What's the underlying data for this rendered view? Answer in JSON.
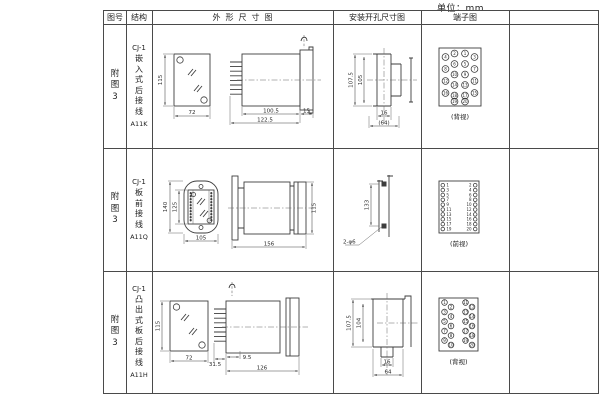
{
  "unit_label": "单位：mm",
  "header": {
    "figure": "图号",
    "structure": "结构",
    "outline": "外形尺寸图",
    "mounting": "安装开孔尺寸图",
    "terminal": "端子图"
  },
  "rows": [
    {
      "figure": "附图3",
      "series": "CJ-1",
      "structure": "嵌入式后接线",
      "model": "A11K",
      "outline": {
        "front_h": "115",
        "front_w": "72",
        "side_a": "100.5",
        "side_b": "122.5",
        "side_c": "15"
      },
      "mounting": {
        "v_outer": "107.5",
        "v_inner": "105",
        "h_inner": "16",
        "h_outer": "(64)"
      },
      "terminal": {
        "caption": "(背视)",
        "outer_left": [
          4,
          8,
          12,
          16
        ],
        "inner_left": [
          2,
          6,
          10,
          14,
          18
        ],
        "inner_right": [
          1,
          5,
          9,
          13,
          17
        ],
        "outer_right": [
          3,
          7,
          11,
          15
        ],
        "bottom": [
          19,
          20
        ]
      }
    },
    {
      "figure": "附图3",
      "series": "CJ-1",
      "structure": "板前接线",
      "model": "A11Q",
      "outline": {
        "front_h_outer": "140",
        "front_h_inner": "125",
        "front_w": "105",
        "side_len": "156",
        "side_h": "115"
      },
      "mounting": {
        "v_dim": "133",
        "hole_note": "2-φ6"
      },
      "terminal": {
        "caption": "(前视)",
        "left": [
          1,
          3,
          5,
          7,
          9,
          11,
          13,
          15,
          17,
          19
        ],
        "right": [
          2,
          4,
          6,
          8,
          10,
          12,
          14,
          16,
          18,
          20
        ]
      }
    },
    {
      "figure": "附图3",
      "series": "CJ-1",
      "structure": "凸出式板后接线",
      "model": "A11H",
      "outline": {
        "front_h": "115",
        "front_w": "72",
        "side_a": "31.5",
        "side_b": "9.5",
        "side_len": "126"
      },
      "mounting": {
        "v_outer": "107.5",
        "v_inner": "104",
        "h_inner": "16",
        "h_outer": "64"
      },
      "terminal": {
        "caption": "(背视)",
        "groups": [
          [
            1,
            2,
            3,
            4,
            5,
            6,
            7,
            8,
            9,
            10
          ],
          [
            11,
            12,
            13,
            14,
            15,
            16,
            17,
            18,
            19,
            20
          ]
        ]
      }
    }
  ]
}
